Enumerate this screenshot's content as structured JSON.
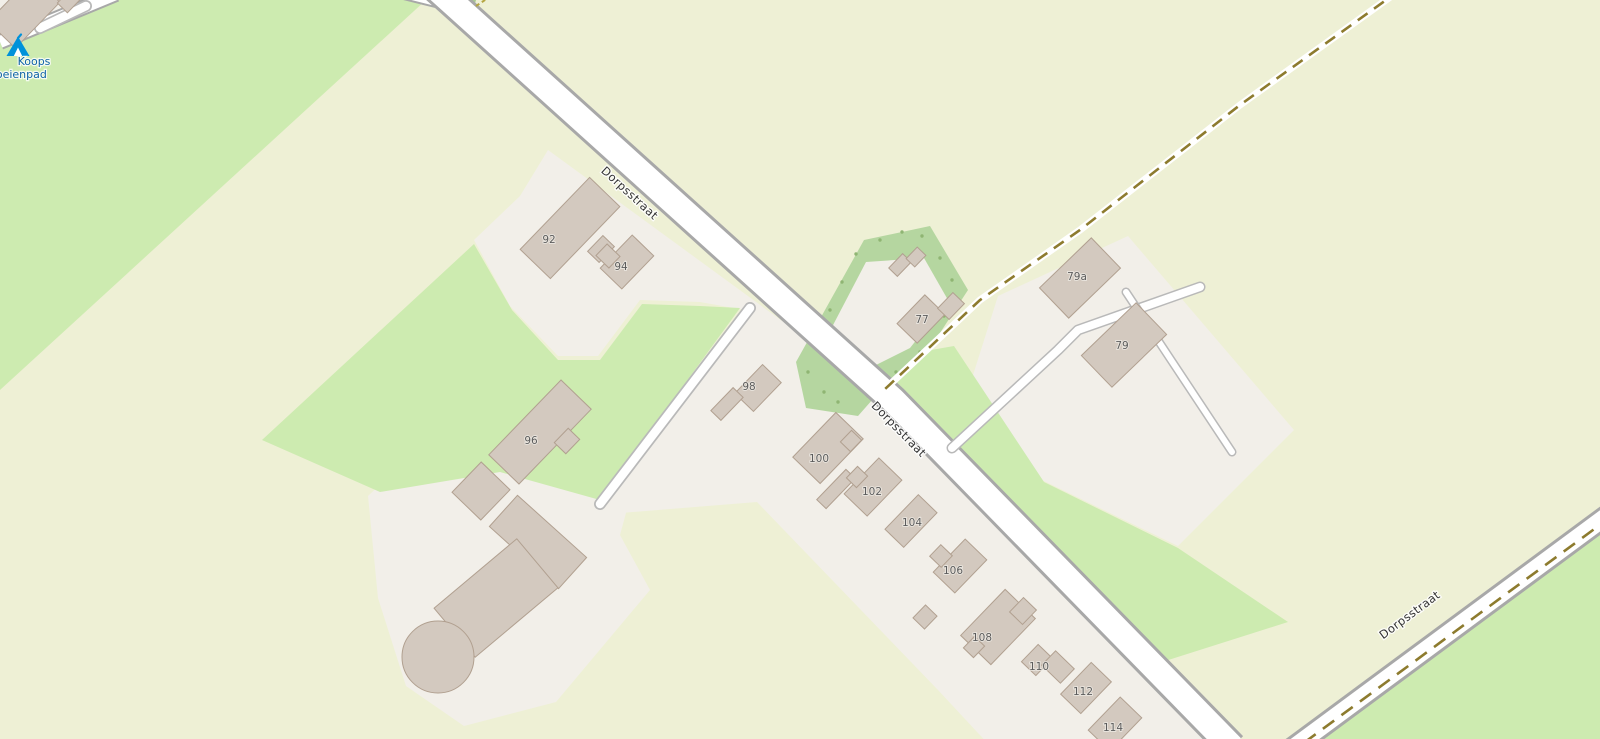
{
  "map": {
    "description": "OpenStreetMap standard-style map view of a rural village street",
    "street_labels": [
      {
        "text": "Dorpsstraat",
        "x": 627,
        "y": 196,
        "rotate": 42.5
      },
      {
        "text": "Dorpsstraat",
        "x": 896,
        "y": 432,
        "rotate": 45.5
      },
      {
        "text": "Dorpsstraat",
        "x": 1412,
        "y": 618,
        "rotate": -36.5
      }
    ],
    "house_numbers": [
      {
        "text": "92",
        "x": 549,
        "y": 243
      },
      {
        "text": "94",
        "x": 621,
        "y": 270
      },
      {
        "text": "96",
        "x": 531,
        "y": 444
      },
      {
        "text": "98",
        "x": 749,
        "y": 390
      },
      {
        "text": "100",
        "x": 819,
        "y": 462
      },
      {
        "text": "102",
        "x": 872,
        "y": 495
      },
      {
        "text": "104",
        "x": 912,
        "y": 526
      },
      {
        "text": "106",
        "x": 953,
        "y": 574
      },
      {
        "text": "108",
        "x": 982,
        "y": 641
      },
      {
        "text": "110",
        "x": 1039,
        "y": 670
      },
      {
        "text": "112",
        "x": 1083,
        "y": 695
      },
      {
        "text": "114",
        "x": 1113,
        "y": 731
      },
      {
        "text": "77",
        "x": 922,
        "y": 323
      },
      {
        "text": "79a",
        "x": 1077,
        "y": 280
      },
      {
        "text": "79",
        "x": 1122,
        "y": 349
      }
    ],
    "poi_campsite": {
      "icon": "campsite-icon",
      "name_line1": "Koops",
      "name_line2": "Koeienpad",
      "x1": 34,
      "y1": 62,
      "x2": 18,
      "y2": 71
    },
    "colors": {
      "farmland": "#eef0d5",
      "land": "#f2efe9",
      "grass": "#cdebb0",
      "scrub": "#b5d6a0",
      "building_fill": "#d3c9bf",
      "building_stroke": "#b1a090",
      "road_fill": "#ffffff",
      "road_casing": "#a8a8a8",
      "path_casing": "#b9b9b9",
      "track_dash": "#8d7b2e",
      "camp_icon": "#0092da",
      "camp_label": "#0f63a6",
      "house_number": "#5c5c5c",
      "street_label": "#333333"
    }
  }
}
